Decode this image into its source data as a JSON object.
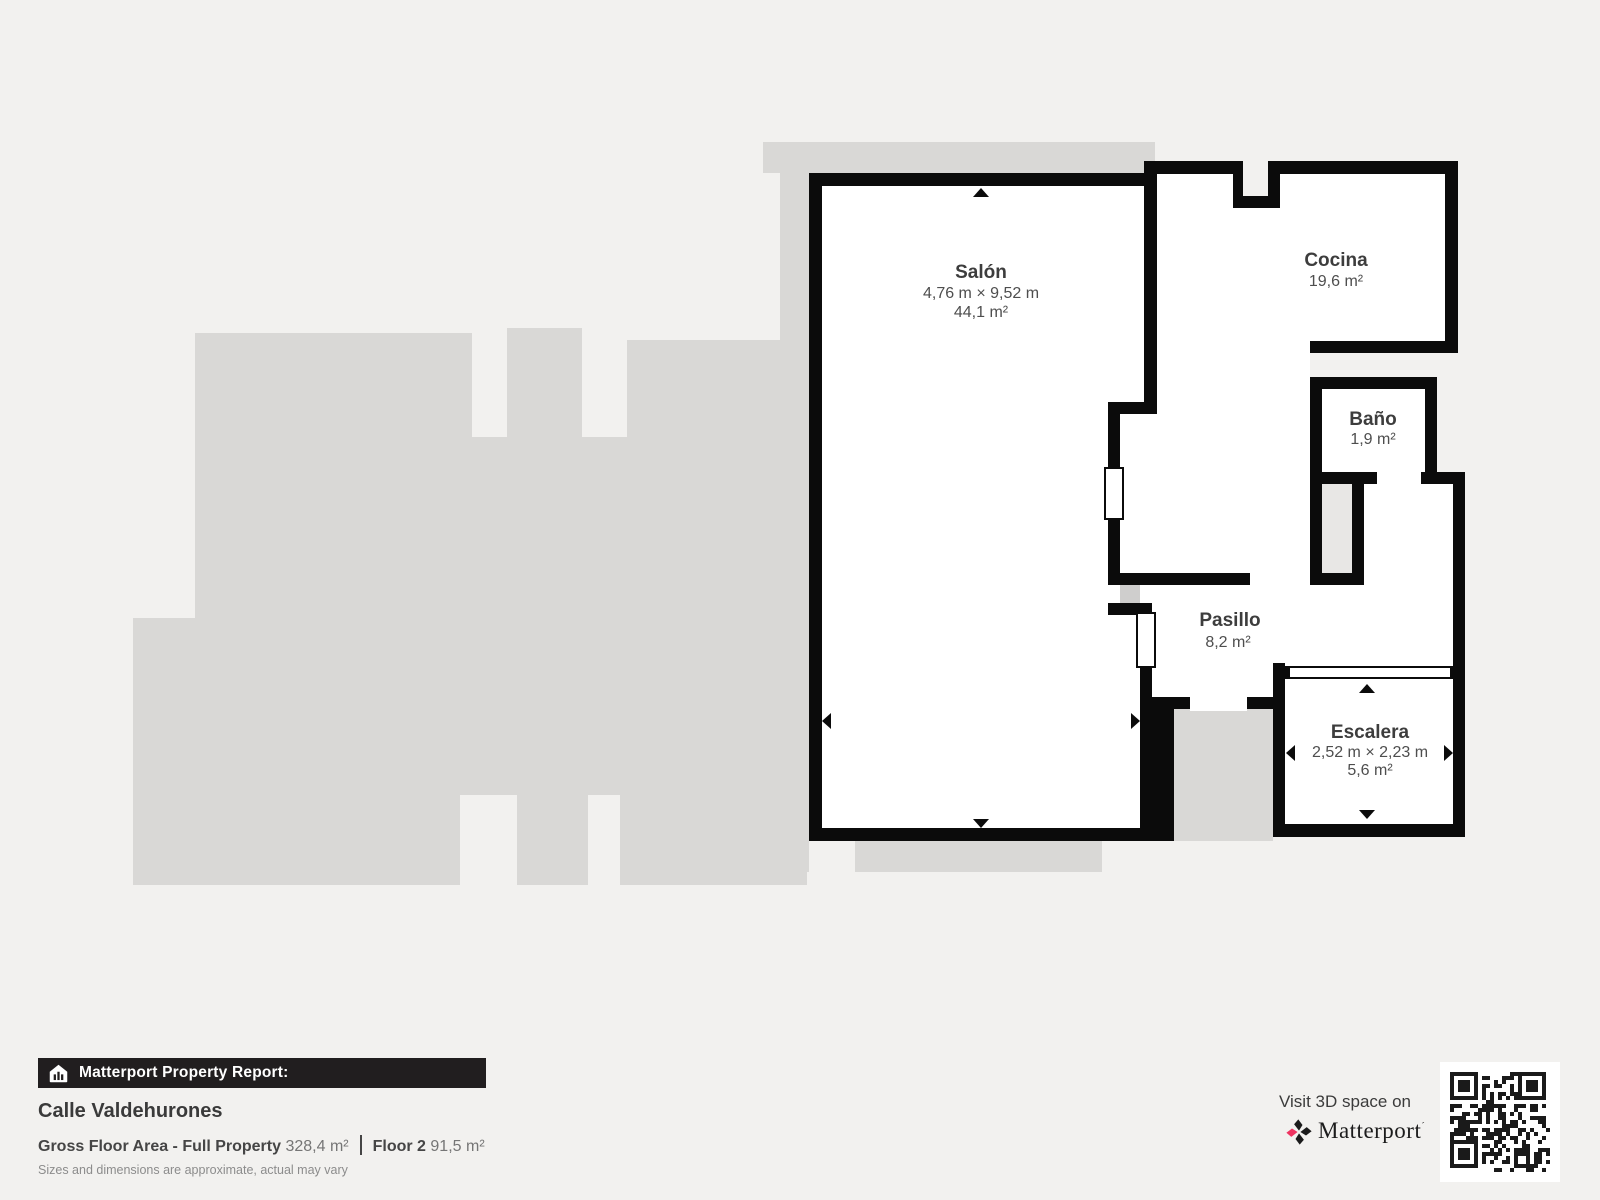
{
  "rooms": [
    {
      "name": "Salón",
      "dims": "4,76 m × 9,52 m",
      "area": "44,1 m²"
    },
    {
      "name": "Cocina",
      "dims": "",
      "area": "19,6 m²"
    },
    {
      "name": "Baño",
      "dims": "",
      "area": "1,9 m²"
    },
    {
      "name": "Pasillo",
      "dims": "",
      "area": "8,2 m²"
    },
    {
      "name": "Escalera",
      "dims": "2,52 m × 2,23 m",
      "area": "5,6 m²"
    }
  ],
  "footer": {
    "banner": "Matterport Property Report:",
    "property_name": "Calle Valdehurones",
    "gross_label": "Gross Floor Area - Full Property",
    "gross_value": "328,4 m²",
    "floor_label": "Floor 2",
    "floor_value": "91,5 m²",
    "disclaimer": "Sizes and dimensions are approximate, actual may vary"
  },
  "cta": {
    "visit": "Visit 3D space on",
    "brand": "Matterport",
    "brand_mark": "´"
  },
  "icons": {
    "banner_icon": "house-icon",
    "brand_icon": "matterport-pinwheel-icon",
    "qr": "qr-code"
  },
  "colors": {
    "background": "#f2f1ef",
    "walls": "#0b0b0b",
    "silhouette": "#d9d8d6",
    "banner_bg": "#211e1f",
    "brand_pink": "#ee3360"
  }
}
